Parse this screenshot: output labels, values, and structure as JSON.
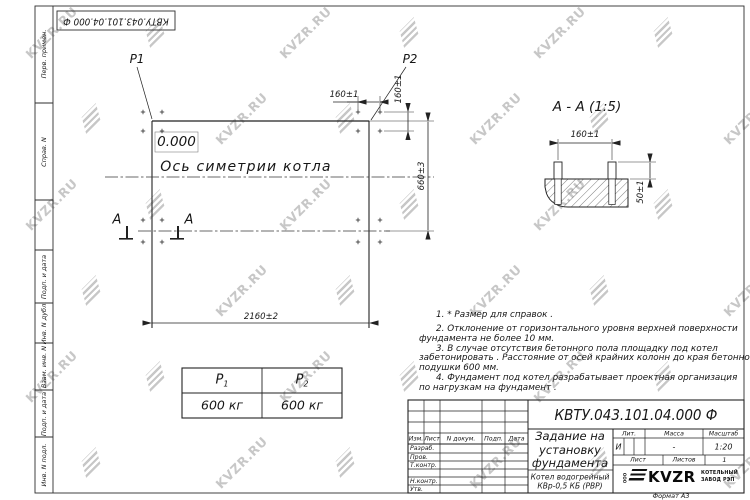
{
  "watermark": {
    "text": "KVZR.RU"
  },
  "top_stamp": {
    "doc_number": "КВТУ.043.101.04.000  Ф"
  },
  "side_labels": {
    "perv": "Перв. примен.",
    "sprav": "Справ. N",
    "podp_data_1": "Подп. и дата",
    "inv_dubl": "Инв. N дубл.",
    "vzam_inv": "Взам. инв. N",
    "podp_data_2": "Подп. и дата",
    "inv_podl": "Инв. N подл."
  },
  "plan": {
    "p1_label": "P1",
    "p2_label": "P2",
    "elevation": "0.000",
    "axis_label": "Ось симетрии котла",
    "dim_160_top": "160±1",
    "dim_160_right": "160±1",
    "dim_660": "660±3",
    "dim_2160": "2160±2",
    "section_letter_left": "A",
    "section_letter_right": "A"
  },
  "section_view": {
    "title": "А - А (1:5)",
    "dim_160": "160±1",
    "dim_50": "50±1"
  },
  "load_table": {
    "col1_label": "P",
    "col1_sub": "1",
    "col1_value": "600 кг",
    "col2_label": "P",
    "col2_sub": "2",
    "col2_value": "600 кг"
  },
  "notes": {
    "line1": "1.  * Размер для справок .",
    "line2": "2.  Отклонение от горизонтального уровня верхней поверхности",
    "line3": "фундамента не более  10  мм.",
    "line4": "3.  В случае отсутствия бетонного пола площадку под котел",
    "line5": "забетонировать . Расстояние от осей крайних колонн до края бетонной",
    "line6": "подушки  600  мм.",
    "line7": "4.  Фундамент под котел разрабатывает проектная организация",
    "line8": "по нагрузкам на фундамент ."
  },
  "title_block": {
    "doc_number": "КВТУ.043.101.04.000  Ф",
    "title_line1": "Задание на",
    "title_line2": "установку",
    "title_line3": "фундамента",
    "product_line1": "Котел водогрейный",
    "product_line2": "КВр-0,5 КБ (РВР)",
    "col_izm": "Изм.",
    "col_list": "Лист",
    "col_ndok": "N докум.",
    "col_podp": "Подп.",
    "col_data": "Дата",
    "row_razrab": "Разраб.",
    "row_prov": "Пров.",
    "row_tkontr": "Т.контр.",
    "row_nkontr": "Н.контр.",
    "row_utv": "Утв.",
    "lit_label": "Лит.",
    "massa_label": "Масса",
    "masshtab_label": "Масштаб",
    "lit_value": "И",
    "massa_value": "-",
    "masshtab_value": "1:20",
    "list_label": "Лист",
    "listov_label": "Листов",
    "listov_value": "1",
    "logo_prefix": "ООО",
    "logo_name": "KVZR",
    "logo_sub1": "КОТЕЛЬНЫЙ",
    "logo_sub2": "ЗАВОД РЭП",
    "format_label": "Формат А3"
  }
}
